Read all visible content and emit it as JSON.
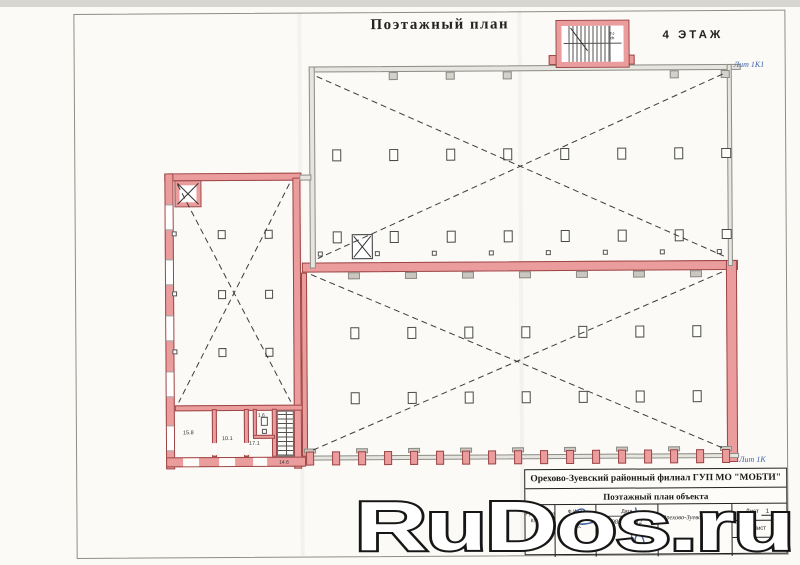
{
  "header": {
    "title": "Поэтажный план",
    "floor": "4 ЭТАЖ"
  },
  "labels": {
    "lit_top": "Лит 1К1",
    "lit_bottom": "Лит 1К"
  },
  "rooms": {
    "stairwell_top": "2.6",
    "left": "15.8",
    "mid": "10.1",
    "right": "17.1",
    "closet": "1.6",
    "stairs_bottom": "14.6"
  },
  "title_block": {
    "org": "Орехово-Зуевский районный филиал ГУП МО \"МОБТИ\"",
    "doc": "Поэтажный план объекта",
    "role_line1": "Руководитель",
    "role_line2": "КПГ №1",
    "fio_label": "Ф.И.О.",
    "fio_name": "Золотова",
    "fio_initials": "С.В.",
    "date_label": "Дата",
    "date_value": "08.10. 2012",
    "region": "Орехово-Зуевский район",
    "sheet_label": "Лист",
    "sheet_value": "1",
    "sheet_row2": "Лист",
    "sheet_row3": "1:100"
  },
  "watermark": {
    "text": "RuDos.ru"
  },
  "colors": {
    "wall_pink": "#eb9d9e",
    "wall_outline": "#9c4545",
    "grey_wall": "#e6e5e0",
    "blue_label": "#3a62a8",
    "paper": "#fbfaf6"
  }
}
